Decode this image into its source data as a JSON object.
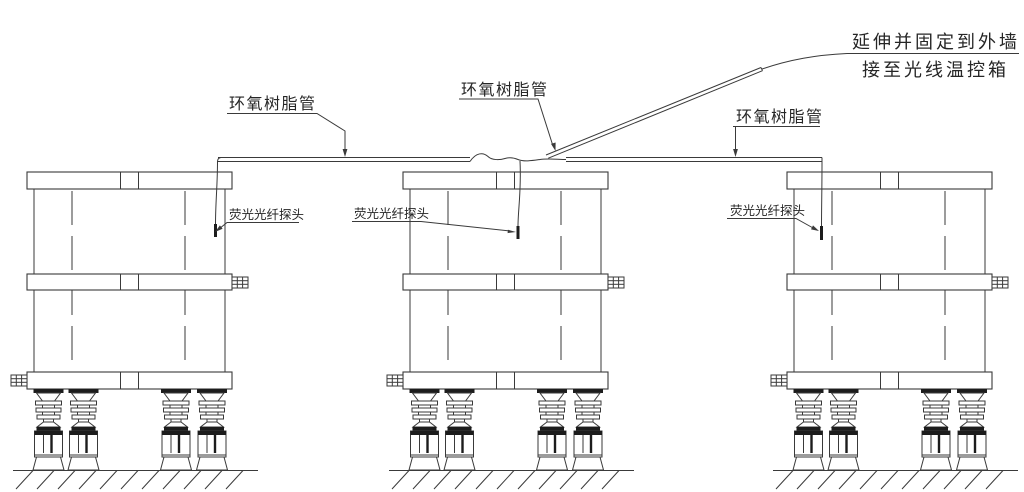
{
  "title": "fiber-optic temperature probe installation diagram",
  "note_top_right": {
    "line1": "延伸并固定到外墙",
    "line2": "接至光线温控箱"
  },
  "labels": {
    "epoxy_tube_left": "环氧树脂管",
    "epoxy_tube_middle": "环氧树脂管",
    "epoxy_tube_right": "环氧树脂管",
    "probe_left": "荧光光纤探头",
    "probe_middle": "荧光光纤探头",
    "probe_right": "荧光光纤探头"
  },
  "colors": {
    "line": "#3a3a3a",
    "dark_fill": "#1c1c1c",
    "text": "#262626",
    "background": "#ffffff"
  }
}
